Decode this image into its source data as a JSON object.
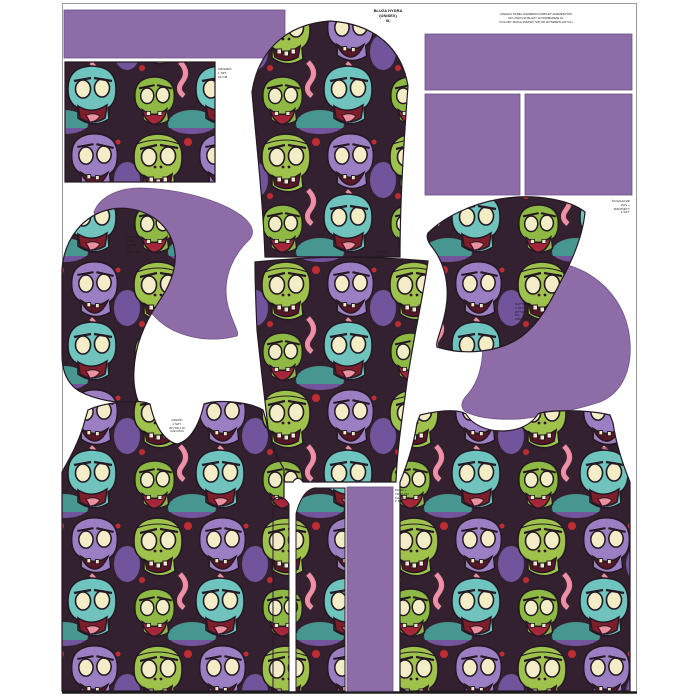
{
  "panel": {
    "title": "BLUZA HYDRA\n(UNISEX)\nXL",
    "notice": "UWAGA! PANEL ZAWIERA KOMPLET ELEMENTÓW\nDO USZYCIA BLUZY W ROZMIARZE XL\nKOLORY MOGĄ RÓŻNIĆ SIĘ OD WYŚWIETLANYCH"
  },
  "colors": {
    "solid_purple": "#8e6ca7",
    "frame": "#9a9a9a",
    "bottom_rule": "#1c1c1c",
    "print_outline": "#241823",
    "print_green": "#9fc24c",
    "print_green_dark": "#8db944",
    "print_teal": "#6fc4bd",
    "print_purple": "#9c7fc2",
    "print_cream": "#f2edc6",
    "print_pink": "#ef8fa4",
    "print_red": "#c22b35",
    "print_bg": "#33212f"
  },
  "labels": {
    "pocket": {
      "text": "KIESZEŃ\n1 SZT.\n20 CM"
    },
    "hood_left": {
      "text": "KAPTUR A\n2 SZT.\nWYTNIJ\nPO\nOBRYSIE"
    },
    "sleeve": {
      "text": "RĘKAW\n2 SZT."
    },
    "hood_right": {
      "text": "KAPTUR B\n2 SZT.\nWYTNIJ\nPO\nOBRYSIE"
    },
    "ribbing": {
      "text": "ŚCIĄGACZE\nPAS +\nMANKIETY\n2 SZT."
    },
    "front": {
      "text": "PRZÓD\n1 SZT.\nWYTNIJ W\nCAŁOŚCI"
    },
    "strips": {
      "text": "PASKI +\nTROCZKI\nKAPTURA\n2 SZT."
    },
    "back": {
      "text": "TYŁ\n1 SZT.\nWYTNIJ W\nCAŁOŚCI"
    }
  },
  "pieces": [
    "waistband-ribbon",
    "pocket-panel",
    "upper-sleeve",
    "lower-sleeve",
    "ribbing-rect-top",
    "ribbing-rect-left",
    "ribbing-rect-right",
    "hood-outer-left-purple",
    "hood-outer-right-print",
    "hood-side-left-print",
    "hood-side-right-purple",
    "front-bodice",
    "back-bodice",
    "drawstring-strip-narrow",
    "drawstring-strip-wide",
    "ribbing-strip-purple"
  ]
}
